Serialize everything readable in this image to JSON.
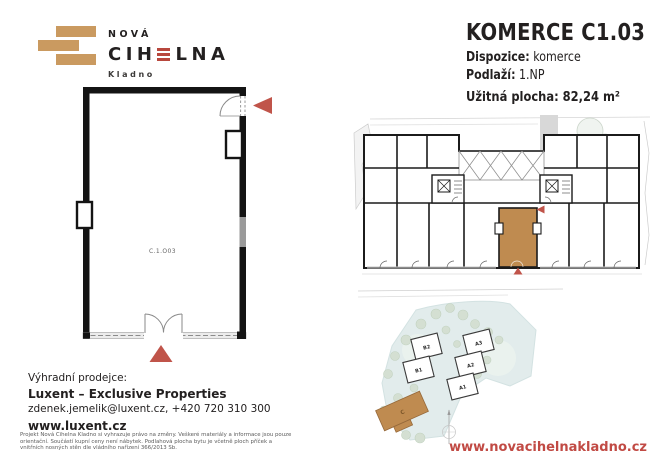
{
  "brand": {
    "name_top": "NOVÁ",
    "name_main_pre": "CIH",
    "name_main_post": "LNA",
    "city": "Kladno"
  },
  "header": {
    "title": "KOMERCE C1.03",
    "specs": [
      {
        "label": "Dispozice:",
        "value": "komerce"
      },
      {
        "label": "Podlaží:",
        "value": "1.NP"
      },
      {
        "label": "Užitná plocha:",
        "value": "82,24 m²"
      }
    ]
  },
  "unit_plan": {
    "room_label": "C.1.O03"
  },
  "site_plan": {
    "labels": [
      "B2",
      "B1",
      "A3",
      "A2",
      "A1",
      "C"
    ]
  },
  "footer": {
    "seller_intro": "Výhradní prodejce:",
    "seller_name": "Luxent – Exclusive Properties",
    "seller_contact": "zdenek.jemelik@luxent.cz, +420 720 310 300",
    "seller_web": "www.luxent.cz",
    "disclaimer": "Projekt Nová Cihelna Kladno si vyhrazuje právo na změny. Veškeré materiály a informace jsou pouze orientační. Součástí kupní ceny není nábytek. Podlahová plocha bytu je včetně ploch příček a vnitřních nosných stěn dle vládního nařízení 366/2013 Sb.",
    "website": "www.novacihelnakladno.cz"
  },
  "colors": {
    "brick_tan": "#ca9a60",
    "accent_red": "#c0544a",
    "logo_red": "#b8473d",
    "unit_highlight": "#bf8b50",
    "text_dark": "#232020",
    "url_red": "#c14a44"
  }
}
